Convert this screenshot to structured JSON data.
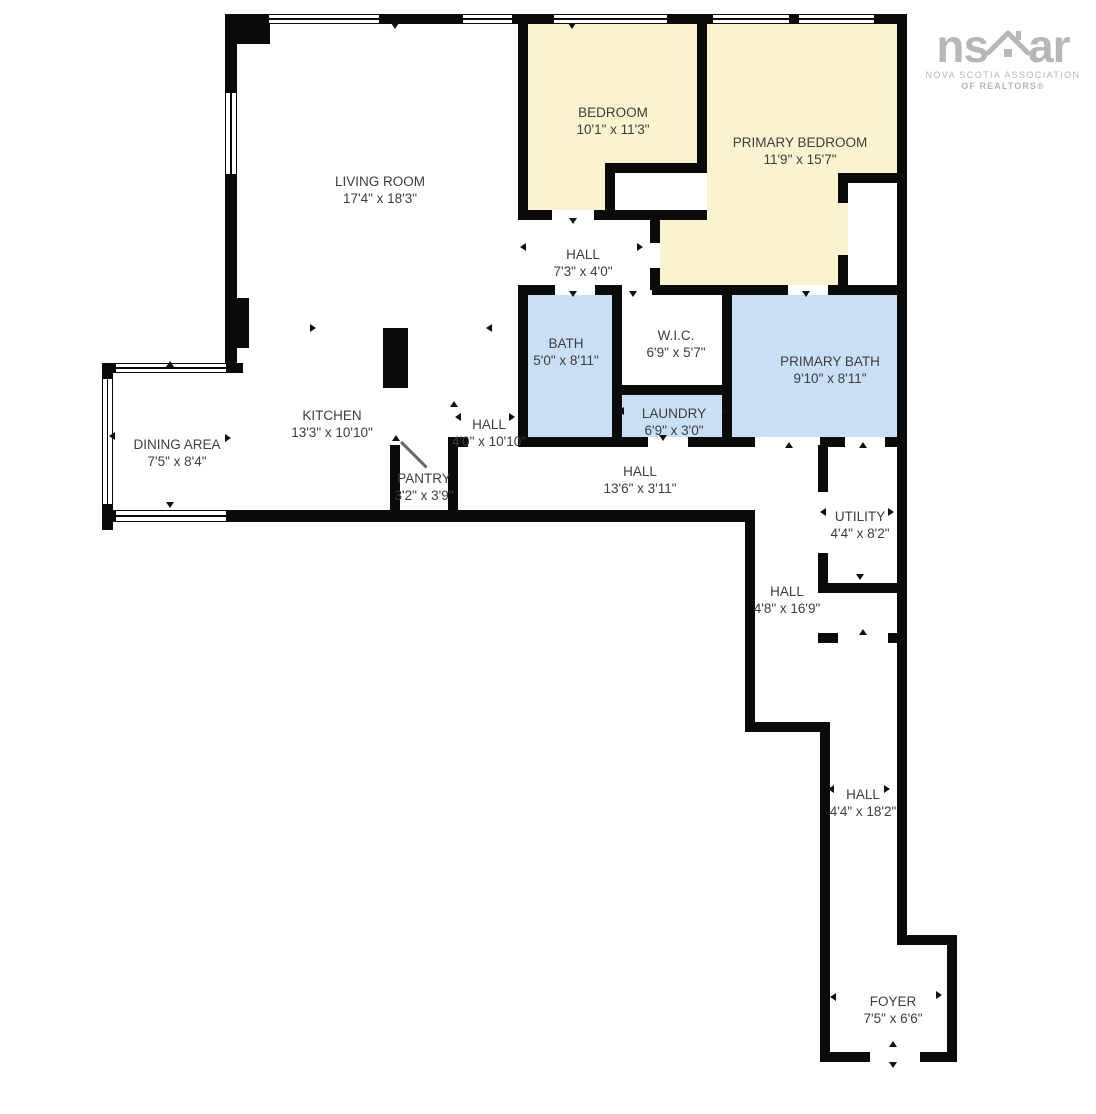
{
  "logo": {
    "text_left": "ns",
    "text_right": "ar",
    "house_icon": "house-roof-icon",
    "line1": "NOVA SCOTIA ASSOCIATION",
    "line2": "OF REALTORS®",
    "color": "#b7b7b7"
  },
  "colors": {
    "bedroom_fill": "#FAF3CF",
    "bath_fill": "#C8DFF5",
    "wall": "#0a0a0a",
    "text": "#3d3d3d"
  },
  "rooms": {
    "living_room": {
      "name": "LIVING ROOM",
      "dims": "17'4\" x 18'3\""
    },
    "bedroom": {
      "name": "BEDROOM",
      "dims": "10'1\" x 11'3\""
    },
    "primary_bedroom": {
      "name": "PRIMARY BEDROOM",
      "dims": "11'9\" x 15'7\""
    },
    "hall_upper": {
      "name": "HALL",
      "dims": "7'3\" x 4'0\""
    },
    "bath": {
      "name": "BATH",
      "dims": "5'0\" x 8'11\""
    },
    "wic": {
      "name": "W.I.C.",
      "dims": "6'9\" x 5'7\""
    },
    "primary_bath": {
      "name": "PRIMARY BATH",
      "dims": "9'10\" x 8'11\""
    },
    "kitchen": {
      "name": "KITCHEN",
      "dims": "13'3\" x 10'10\""
    },
    "hall_mid": {
      "name": "HALL",
      "dims": "4'0\" x 10'10\""
    },
    "laundry": {
      "name": "LAUNDRY",
      "dims": "6'9\" x 3'0\""
    },
    "dining_area": {
      "name": "DINING AREA",
      "dims": "7'5\" x 8'4\""
    },
    "pantry": {
      "name": "PANTRY",
      "dims": "3'2\" x 3'9\""
    },
    "hall_main": {
      "name": "HALL",
      "dims": "13'6\" x 3'11\""
    },
    "utility": {
      "name": "UTILITY",
      "dims": "4'4\" x 8'2\""
    },
    "hall_south": {
      "name": "HALL",
      "dims": "4'8\" x 16'9\""
    },
    "hall_corridor": {
      "name": "HALL",
      "dims": "4'4\" x 18'2\""
    },
    "foyer": {
      "name": "FOYER",
      "dims": "7'5\" x 6'6\""
    }
  }
}
